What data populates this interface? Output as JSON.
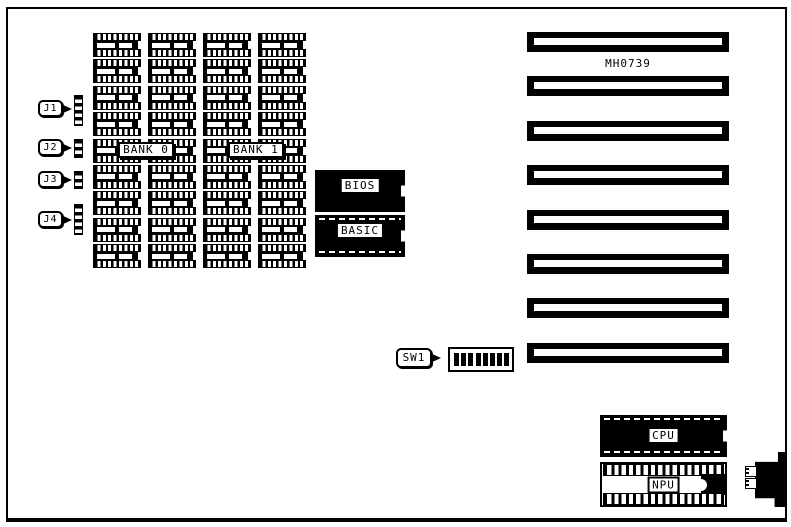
{
  "diagram": {
    "board_label": "MH0739",
    "jumpers": [
      {
        "id": "J1"
      },
      {
        "id": "J2"
      },
      {
        "id": "J3"
      },
      {
        "id": "J4"
      }
    ],
    "dip_switch": {
      "id": "SW1",
      "switch_count": 8
    },
    "memory": {
      "rows": 9,
      "cols": 4,
      "banks": [
        {
          "label": "BANK 0"
        },
        {
          "label": "BANK 1"
        }
      ]
    },
    "rom_chips": [
      {
        "label": "BIOS"
      },
      {
        "label": "BASIC"
      }
    ],
    "processor_chips": [
      {
        "label": "CPU"
      },
      {
        "label": "NPU"
      }
    ],
    "expansion_slots": {
      "count": 8
    },
    "colors": {
      "foreground": "#000000",
      "background": "#ffffff"
    }
  }
}
